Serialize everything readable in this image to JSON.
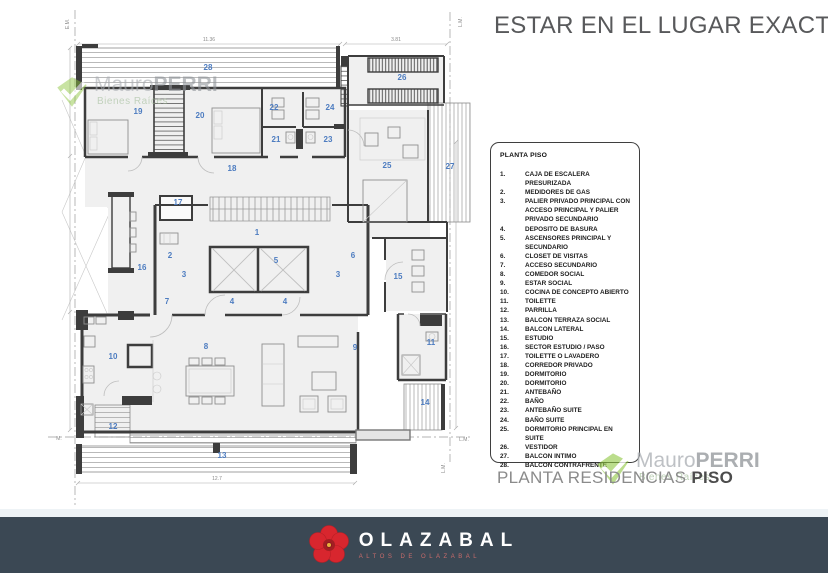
{
  "header": {
    "title": "ESTAR EN EL LUGAR EXACTO."
  },
  "legend": {
    "heading": "PLANTA PISO",
    "items": [
      {
        "num": "1.",
        "label": "CAJA DE ESCALERA PRESURIZADA"
      },
      {
        "num": "2.",
        "label": "MEDIDORES DE GAS"
      },
      {
        "num": "3.",
        "label": "PALIER PRIVADO PRINCIPAL  CON ACCESO PRINCIPAL Y PALIER PRIVADO SECUNDARIO"
      },
      {
        "num": "4.",
        "label": "DEPOSITO DE BASURA"
      },
      {
        "num": "5.",
        "label": "ASCENSORES PRINCIPAL Y SECUNDARIO"
      },
      {
        "num": "6.",
        "label": "CLOSET DE VISITAS"
      },
      {
        "num": "7.",
        "label": "ACCESO SECUNDARIO"
      },
      {
        "num": "8.",
        "label": "COMEDOR SOCIAL"
      },
      {
        "num": "9.",
        "label": "ESTAR SOCIAL"
      },
      {
        "num": "10.",
        "label": "COCINA DE CONCEPTO ABIERTO"
      },
      {
        "num": "11.",
        "label": "TOILETTE"
      },
      {
        "num": "12.",
        "label": "PARRILLA"
      },
      {
        "num": "13.",
        "label": "BALCON TERRAZA SOCIAL"
      },
      {
        "num": "14.",
        "label": "BALCON LATERAL"
      },
      {
        "num": "15.",
        "label": "ESTUDIO"
      },
      {
        "num": "16.",
        "label": "SECTOR ESTUDIO / PASO"
      },
      {
        "num": "17.",
        "label": "TOILETTE O LAVADERO"
      },
      {
        "num": "18.",
        "label": "CORREDOR PRIVADO"
      },
      {
        "num": "19.",
        "label": "DORMITORIO"
      },
      {
        "num": "20.",
        "label": "DORMITORIO"
      },
      {
        "num": "21.",
        "label": "ANTEBAÑO"
      },
      {
        "num": "22.",
        "label": "BAÑO"
      },
      {
        "num": "23.",
        "label": "ANTEBAÑO SUITE"
      },
      {
        "num": "24.",
        "label": "BAÑO SUITE"
      },
      {
        "num": "25.",
        "label": "DORMITORIO PRINCIPAL EN SUITE"
      },
      {
        "num": "26.",
        "label": "VESTIDOR"
      },
      {
        "num": "27.",
        "label": "BALCON INTIMO"
      },
      {
        "num": "28.",
        "label": "BALCON CONTRAFRENTE"
      }
    ]
  },
  "caption": {
    "regular": "PLANTA RESIDENCIAS ",
    "bold": "PISO"
  },
  "watermark": {
    "name_light": "Mauro",
    "name_bold": "PERRI",
    "subtitle": "Bienes Raíces"
  },
  "brand_bar": {
    "name": "OLAZABAL",
    "subtitle": "ALTOS DE OLAZABAL"
  },
  "plan": {
    "room_labels": [
      {
        "n": "28",
        "x": 208,
        "y": 70
      },
      {
        "n": "26",
        "x": 402,
        "y": 80
      },
      {
        "n": "19",
        "x": 138,
        "y": 114
      },
      {
        "n": "20",
        "x": 200,
        "y": 118
      },
      {
        "n": "22",
        "x": 274,
        "y": 110
      },
      {
        "n": "24",
        "x": 330,
        "y": 110
      },
      {
        "n": "21",
        "x": 276,
        "y": 142
      },
      {
        "n": "23",
        "x": 328,
        "y": 142
      },
      {
        "n": "25",
        "x": 387,
        "y": 168
      },
      {
        "n": "27",
        "x": 450,
        "y": 169
      },
      {
        "n": "18",
        "x": 232,
        "y": 171
      },
      {
        "n": "17",
        "x": 178,
        "y": 205
      },
      {
        "n": "1",
        "x": 257,
        "y": 235
      },
      {
        "n": "2",
        "x": 170,
        "y": 258
      },
      {
        "n": "5",
        "x": 276,
        "y": 263
      },
      {
        "n": "6",
        "x": 353,
        "y": 258
      },
      {
        "n": "3",
        "x": 184,
        "y": 277
      },
      {
        "n": "3",
        "x": 338,
        "y": 277
      },
      {
        "n": "16",
        "x": 142,
        "y": 270
      },
      {
        "n": "15",
        "x": 398,
        "y": 279
      },
      {
        "n": "7",
        "x": 167,
        "y": 304
      },
      {
        "n": "4",
        "x": 232,
        "y": 304
      },
      {
        "n": "4",
        "x": 285,
        "y": 304
      },
      {
        "n": "8",
        "x": 206,
        "y": 349
      },
      {
        "n": "9",
        "x": 355,
        "y": 350
      },
      {
        "n": "10",
        "x": 113,
        "y": 359
      },
      {
        "n": "11",
        "x": 431,
        "y": 345
      },
      {
        "n": "12",
        "x": 113,
        "y": 429
      },
      {
        "n": "14",
        "x": 425,
        "y": 405
      },
      {
        "n": "13",
        "x": 222,
        "y": 458
      }
    ],
    "dim_labels": [
      {
        "t": "11.36",
        "x": 209,
        "y": 41
      },
      {
        "t": "3.81",
        "x": 396,
        "y": 41
      },
      {
        "t": "12.7",
        "x": 217,
        "y": 480
      }
    ],
    "boundary_labels": [
      {
        "t": "E.M.",
        "x": 69,
        "y": 24,
        "rot": -90
      },
      {
        "t": "L.M.",
        "x": 462,
        "y": 22,
        "rot": -90
      },
      {
        "t": "M.",
        "x": 59,
        "y": 440,
        "rot": 0
      },
      {
        "t": "L.M.",
        "x": 464,
        "y": 441,
        "rot": 0
      },
      {
        "t": "L.M.",
        "x": 445,
        "y": 468,
        "rot": -90
      }
    ]
  },
  "colors": {
    "accent_blue": "#4d7cc0",
    "footer_bar": "#3b4854",
    "flower_red": "#d8262e",
    "watermark_green": "#8dc63f",
    "title_grey": "#58595b"
  }
}
